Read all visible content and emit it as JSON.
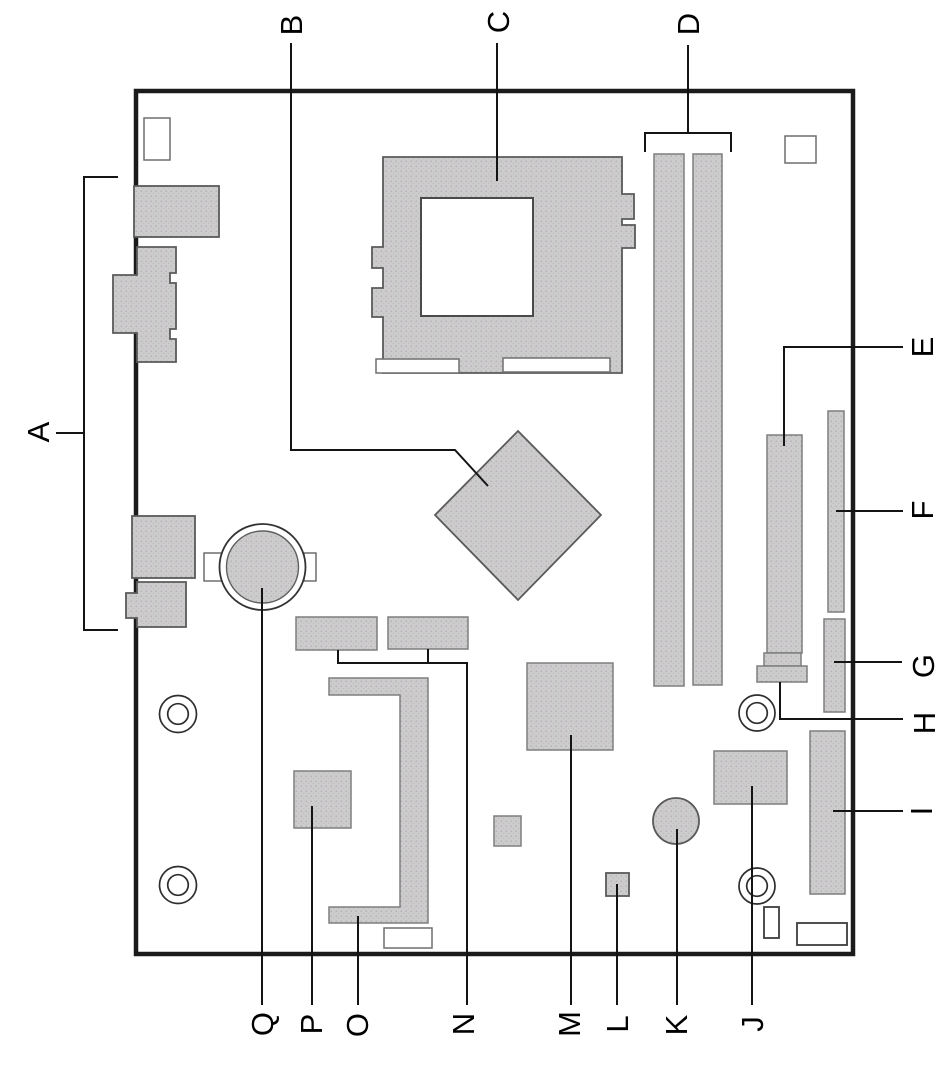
{
  "callouts": {
    "a": "A",
    "b": "B",
    "c": "C",
    "d": "D",
    "e": "E",
    "f": "F",
    "g": "G",
    "h": "H",
    "i": "I",
    "j": "J",
    "k": "K",
    "l": "L",
    "m": "M",
    "n": "N",
    "o": "O",
    "p": "P",
    "q": "Q"
  },
  "colors": {
    "background": "#ffffff",
    "board_fill": "#ffffff",
    "board_border": "#1b1b1b",
    "component_fill": "#cbcbcb",
    "component_outline": "#7e7e7e",
    "callout_line": "#141414",
    "label_text": "#000000"
  }
}
